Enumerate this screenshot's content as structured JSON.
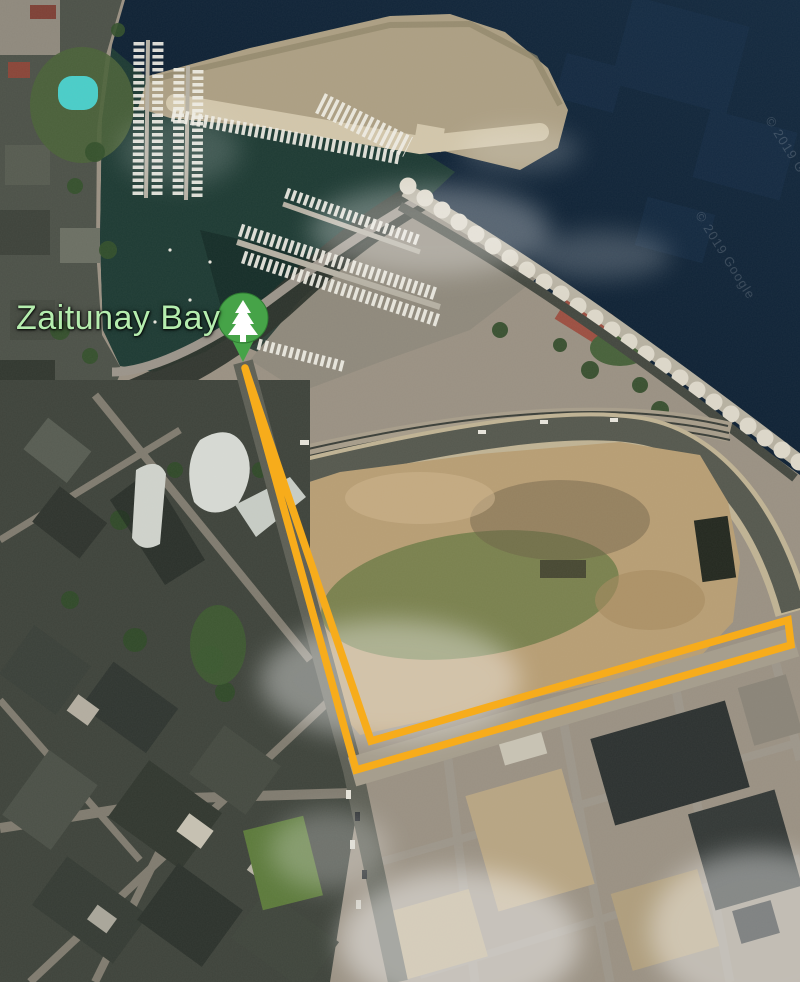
{
  "map": {
    "view": "satellite",
    "label": {
      "text": "Zaitunay Bay",
      "color": "#B5EDAE"
    },
    "pin": {
      "icon": "park-tree-pin",
      "color": "#46A348",
      "glyph_color": "#FFFFFF"
    },
    "route": {
      "color": "#F7AC1B",
      "points": "245,368 356,770 791,645 788,620 371,741 245,368",
      "description": "out-and-back route from Zaitunay Bay pin, south along street then east along avenue"
    },
    "watermarks": [
      {
        "text": "© 2019 Google"
      },
      {
        "text": "© 2019 Google"
      }
    ],
    "colors": {
      "sea": "#0E2134",
      "marina_water": "#1D3A33",
      "breakwater": "#AC9F83",
      "seawall_scallops": "#DDD8CA",
      "dirt_lot": "#B89E74",
      "city_dark": "#3E433B",
      "roads": "#9D968A",
      "pool": "#49CDC9"
    }
  }
}
